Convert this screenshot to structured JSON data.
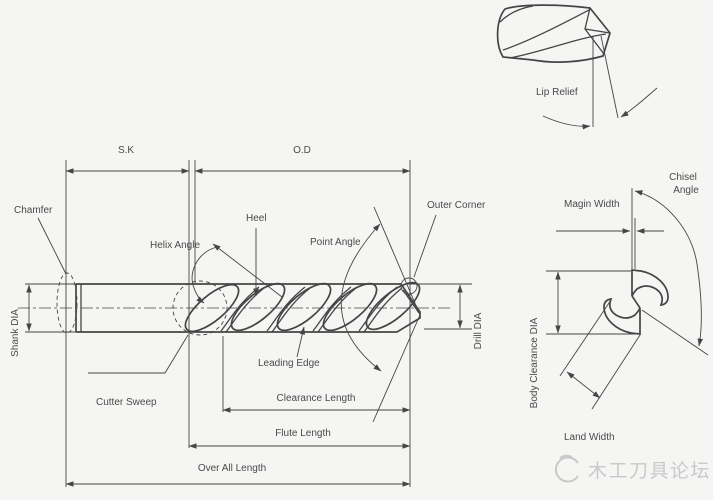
{
  "colors": {
    "line": "#454545",
    "label": "#4a4a4a",
    "background": "#f5f5f4",
    "watermark": "#c9c9c9"
  },
  "main_view": {
    "sk": "S.K",
    "od": "O.D",
    "chamfer": "Chamfer",
    "shank_dia": "Shank DIA",
    "helix_angle": "Helix Angle",
    "heel": "Heel",
    "point_angle": "Point Angle",
    "outer_corner": "Outer Corner",
    "drill_dia": "Drill DIA",
    "leading_edge": "Leading Edge",
    "cutter_sweep": "Cutter Sweep",
    "clearance_length": "Clearance Length",
    "flute_length": "Flute Length",
    "over_all_length": "Over All Length"
  },
  "tip_view": {
    "lip_relief": "Lip Relief"
  },
  "end_view": {
    "chisel_angle_line1": "Chisel",
    "chisel_angle_line2": "Angle",
    "magin_width": "Magin Width",
    "body_clearance_dia": "Body Clearance DIA",
    "land_width": "Land Width"
  },
  "watermark": {
    "text": "木工刀具论坛"
  }
}
